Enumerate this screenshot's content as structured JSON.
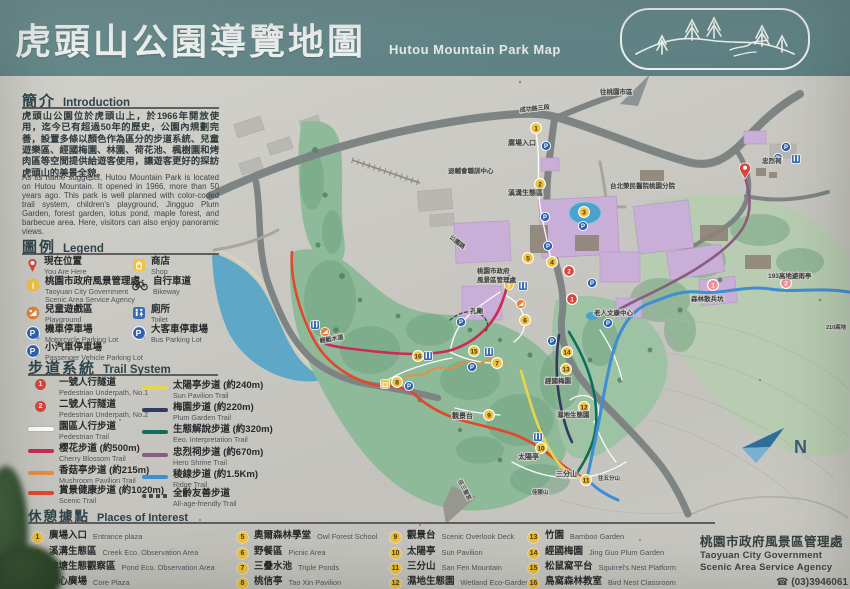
{
  "header": {
    "title_zh": "虎頭山公園導覽地圖",
    "title_en": "Hutou Mountain Park Map",
    "logo_icon": "park-logo"
  },
  "intro": {
    "heading_zh": "簡介",
    "heading_en": "Introduction",
    "para_zh": "虎頭山公園位於虎頭山上，於1966年開放使用，迄今已有超過50年的歷史，公園內規劃完善，設置多條以顏色作為區分的步道系統、兒童遊樂區、經國梅園、林園、荷花池、楓樹園和烤肉區等空間提供給遊客使用，讓遊客更好的探訪虎頭山的美景全貌。",
    "para_en": "As its name suggests, Hutou Mountain Park is located on Hutou Mountain. It opened in 1966, more than 50 years ago. This park is well planned with color-coded trail system, children's playground, Jingguo Plum Garden, forest garden, lotus pond, maple forest, and barbecue area. Here, visitors can also enjoy panoramic views."
  },
  "legend": {
    "heading_zh": "圖例",
    "heading_en": "Legend",
    "items": [
      {
        "icon": "you-are-here-pin",
        "zh": "現在位置",
        "en": "You Are Here"
      },
      {
        "icon": "info",
        "zh": "桃園市政府風景管理處",
        "en": "Taoyuan City Government Scenic Area Service Agency"
      },
      {
        "icon": "playground",
        "zh": "兒童遊戲區",
        "en": "Playground"
      },
      {
        "icon": "parking-moto",
        "zh": "機車停車場",
        "en": "Motorcycle Parking Lot"
      },
      {
        "icon": "parking-car",
        "zh": "小汽車停車場",
        "en": "Passenger Vehicle Parking Lot"
      },
      {
        "icon": "shop",
        "zh": "商店",
        "en": "Shop"
      },
      {
        "icon": "bike",
        "zh": "自行車道",
        "en": "Bikeway"
      },
      {
        "icon": "toilet",
        "zh": "廁所",
        "en": "Toilet"
      },
      {
        "icon": "parking-bus",
        "zh": "大客車停車場",
        "en": "Bus Parking Lot"
      }
    ]
  },
  "trails": {
    "heading_zh": "步道系統",
    "heading_en": "Trail System",
    "items": [
      {
        "marker": "num1",
        "zh": "一號人行隧道",
        "en": "Pedestrian Underpath, No.1"
      },
      {
        "marker": "num2",
        "zh": "二號人行隧道",
        "en": "Pedestrian Underpath, No.2"
      },
      {
        "marker": "white",
        "zh": "園區人行步道",
        "en": "Pedestrian Trail"
      },
      {
        "marker": "crimson",
        "zh": "櫻花步道 (約500m)",
        "en": "Cherry Blossom Trail"
      },
      {
        "marker": "orange",
        "zh": "香菇亭步道 (約215m)",
        "en": "Mushroom Pavilion Trail"
      },
      {
        "marker": "red",
        "zh": "賞景健康步道 (約1020m)",
        "en": "Scenic Trail"
      },
      {
        "marker": "yellow",
        "zh": "太陽亭步道 (約240m)",
        "en": "Sun Pavilion Trail"
      },
      {
        "marker": "navy",
        "zh": "梅園步道 (約220m)",
        "en": "Plum Garden Trail"
      },
      {
        "marker": "teal",
        "zh": "生態解說步道 (約320m)",
        "en": "Eeo. Interpretation Trail"
      },
      {
        "marker": "purple",
        "zh": "忠烈祠步道 (約670m)",
        "en": "Hero Shrine Trail"
      },
      {
        "marker": "blue",
        "zh": "稜線步道 (約1.5Km)",
        "en": "Ridge Trail"
      },
      {
        "marker": "dash",
        "zh": "全齡友善步道",
        "en": "All-age-friendly Trail"
      }
    ]
  },
  "places": {
    "heading_zh": "休憩據點",
    "heading_en": "Places of Interest",
    "items": [
      {
        "num": "1",
        "zh": "廣場入口",
        "en": "Entrance plaza"
      },
      {
        "num": "2",
        "zh": "溪溝生態區",
        "en": "Creek Eco. Observation Area"
      },
      {
        "num": "3",
        "zh": "埤塘生態觀察區",
        "en": "Pond Eco. Observation Area"
      },
      {
        "num": "4",
        "zh": "核心廣場",
        "en": "Core Plaza"
      },
      {
        "num": "5",
        "zh": "奧爾森林學堂",
        "en": "Owl Forest School"
      },
      {
        "num": "6",
        "zh": "野餐區",
        "en": "Picnic Area"
      },
      {
        "num": "7",
        "zh": "三疊水池",
        "en": "Triple Ponds"
      },
      {
        "num": "8",
        "zh": "桃信亭",
        "en": "Tao Xin Pavilion"
      },
      {
        "num": "9",
        "zh": "觀景台",
        "en": "Scenic Overlook Deck"
      },
      {
        "num": "10",
        "zh": "太陽亭",
        "en": "Sun Pavilion"
      },
      {
        "num": "11",
        "zh": "三分山",
        "en": "San Fen Mountain"
      },
      {
        "num": "12",
        "zh": "濕地生態園",
        "en": "Wetland Eco-Garden"
      },
      {
        "num": "13",
        "zh": "竹園",
        "en": "Bamboo Garden"
      },
      {
        "num": "14",
        "zh": "經國梅園",
        "en": "Jing Guo Plum Garden"
      },
      {
        "num": "15",
        "zh": "松鼠窩平台",
        "en": "Squirrel's Nest Platform"
      },
      {
        "num": "16",
        "zh": "鳥窩森林教室",
        "en": "Bird Nest Classroom"
      }
    ]
  },
  "agency": {
    "zh": "桃園市政府風景區管理處",
    "en_line1": "Taoyuan City Government",
    "en_line2": "Scenic Area Service Agency",
    "phone_icon": "☎",
    "phone": "(03)3946061"
  },
  "map": {
    "compass_label": "N",
    "labels": [
      {
        "t": "往桃園市區",
        "x": 600,
        "y": 94,
        "s": 6.5
      },
      {
        "t": "成功路三段",
        "x": 520,
        "y": 112,
        "s": 6,
        "r": -6
      },
      {
        "t": "退輔會職訓中心",
        "x": 448,
        "y": 173,
        "s": 6.5
      },
      {
        "t": "廣場入口",
        "x": 508,
        "y": 145,
        "s": 7
      },
      {
        "t": "溪溝生態區",
        "x": 508,
        "y": 195,
        "s": 7
      },
      {
        "t": "台北榮民醫院桃園分院",
        "x": 610,
        "y": 188,
        "s": 6.5
      },
      {
        "t": "忠烈祠",
        "x": 762,
        "y": 163,
        "s": 6.5
      },
      {
        "t": "公園路",
        "x": 449,
        "y": 238,
        "s": 6,
        "r": 38
      },
      {
        "t": "桃園市政府",
        "x": 477,
        "y": 273,
        "s": 6.5
      },
      {
        "t": "風景區管理處",
        "x": 477,
        "y": 282,
        "s": 6.5
      },
      {
        "t": "孔廟",
        "x": 470,
        "y": 313,
        "s": 6.5
      },
      {
        "t": "老人文康中心",
        "x": 594,
        "y": 315,
        "s": 6.5
      },
      {
        "t": "輕艇水道",
        "x": 320,
        "y": 343,
        "s": 6,
        "r": -10
      },
      {
        "t": "經國梅園",
        "x": 545,
        "y": 383,
        "s": 6.5
      },
      {
        "t": "濕地生態園",
        "x": 557,
        "y": 417,
        "s": 6.5
      },
      {
        "t": "觀景台",
        "x": 452,
        "y": 418,
        "s": 7
      },
      {
        "t": "太陽亭",
        "x": 518,
        "y": 459,
        "s": 7
      },
      {
        "t": "三分山",
        "x": 556,
        "y": 476,
        "s": 7
      },
      {
        "t": "森林散兵坑",
        "x": 691,
        "y": 301,
        "s": 6.5
      },
      {
        "t": "193高地避雨亭",
        "x": 768,
        "y": 278,
        "s": 6.5
      },
      {
        "t": "往五分山",
        "x": 598,
        "y": 480,
        "s": 5.5
      },
      {
        "t": "佳陵山",
        "x": 532,
        "y": 494,
        "s": 5.5
      },
      {
        "t": "往三聖宮",
        "x": 458,
        "y": 481,
        "s": 5.5,
        "r": 62
      },
      {
        "t": "210高地",
        "x": 826,
        "y": 329,
        "s": 5.5
      }
    ],
    "markers_yellow": [
      [
        1,
        536,
        128
      ],
      [
        2,
        540,
        184
      ],
      [
        3,
        584,
        212
      ],
      [
        4,
        552,
        262
      ],
      [
        5,
        528,
        258
      ],
      [
        6,
        525,
        320
      ],
      [
        7,
        497,
        363
      ],
      [
        8,
        397,
        382
      ],
      [
        9,
        489,
        415
      ],
      [
        10,
        541,
        448
      ],
      [
        11,
        586,
        480
      ],
      [
        12,
        584,
        407
      ],
      [
        13,
        566,
        369
      ],
      [
        14,
        567,
        352
      ],
      [
        15,
        474,
        351
      ],
      [
        16,
        418,
        356
      ]
    ],
    "markers_red": [
      [
        1,
        572,
        299
      ],
      [
        2,
        569,
        271
      ]
    ],
    "markers_pink": [
      [
        1,
        713,
        285
      ],
      [
        2,
        786,
        283
      ]
    ],
    "parking": [
      [
        546,
        146
      ],
      [
        545,
        217
      ],
      [
        583,
        226
      ],
      [
        548,
        246
      ],
      [
        461,
        322
      ],
      [
        472,
        367
      ],
      [
        592,
        283
      ],
      [
        608,
        323
      ],
      [
        552,
        341
      ],
      [
        409,
        386
      ],
      [
        786,
        147
      ],
      [
        778,
        158
      ]
    ],
    "toilets": [
      [
        796,
        159
      ],
      [
        523,
        286
      ],
      [
        428,
        356
      ],
      [
        489,
        352
      ],
      [
        538,
        437
      ],
      [
        315,
        325
      ]
    ],
    "pins": [
      [
        745,
        172
      ]
    ],
    "info_pts": [
      [
        509,
        285
      ]
    ],
    "playgrounds": [
      [
        521,
        304
      ],
      [
        325,
        332
      ]
    ],
    "shops": [
      [
        385,
        384
      ]
    ]
  },
  "colors": {
    "header_teal": "#64878a",
    "paper": "#cac9c3",
    "park_green": "#8fba99",
    "park_green_light": "#b7ccb0",
    "lake_blue": "#5ea7c6",
    "road_grey": "#7d8483",
    "building_purple": "#c9aed7",
    "trail_crimson": "#cb2a56",
    "trail_orange": "#e78f3f",
    "trail_red": "#e2472e",
    "trail_yellow": "#e9d44d",
    "trail_navy": "#323a60",
    "trail_teal": "#0e6e59",
    "trail_purple": "#8a5c7d",
    "trail_blue": "#3e8ed3",
    "marker_yellow": "#f1c23c",
    "marker_red": "#d9453c",
    "marker_pink": "#ee8e95",
    "parking_blue": "#2f62ae",
    "toilet_blue": "#3a6cb0"
  }
}
